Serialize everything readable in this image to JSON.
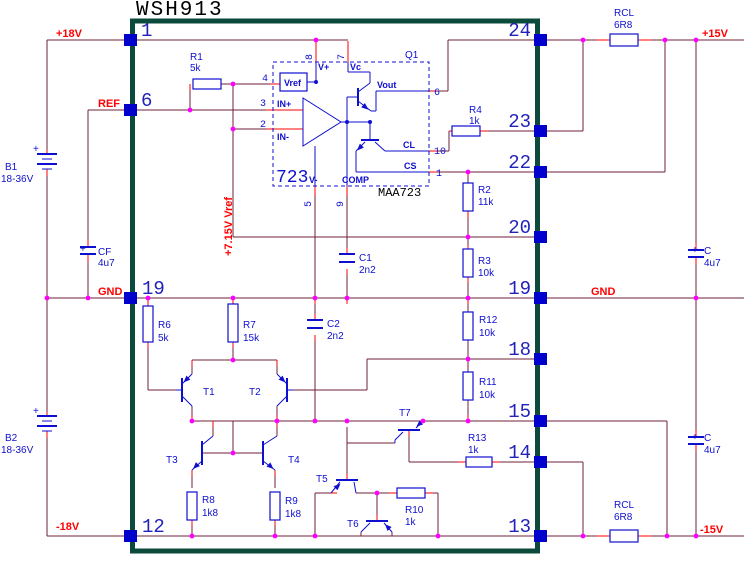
{
  "title": "WSH913",
  "part_label": "MAA723",
  "ic": {
    "big": "723",
    "q1": "Q1",
    "vref_box": "Vref",
    "ports": {
      "vplus": "V+",
      "vc": "Vc",
      "vminus": "V-",
      "comp": "COMP",
      "inp": "IN+",
      "inm": "IN-",
      "vout": "Vout",
      "cl": "CL",
      "cs": "CS"
    },
    "pin_numbers": {
      "n4": "4",
      "n3": "3",
      "n2": "2",
      "n8": "8",
      "n7": "7",
      "n6": "6",
      "n10": "10",
      "n1": "1",
      "n5": "5",
      "n9": "9"
    }
  },
  "nets": {
    "p18": "+18V",
    "ref": "REF",
    "gnd_left": "GND",
    "m18": "-18V",
    "p15": "+15V",
    "gnd_right": "GND",
    "m15": "-15V",
    "vref_rail": "+7.15V Vref"
  },
  "pins": {
    "left": [
      "1",
      "6",
      "19",
      "12"
    ],
    "right": [
      "24",
      "23",
      "22",
      "20",
      "19",
      "18",
      "15",
      "14",
      "13"
    ]
  },
  "batteries": {
    "b1": {
      "name": "B1",
      "value": "18-36V"
    },
    "b2": {
      "name": "B2",
      "value": "18-36V"
    }
  },
  "capacitors": {
    "cf": {
      "name": "CF",
      "value": "4u7"
    },
    "c1": {
      "name": "C1",
      "value": "2n2"
    },
    "c2": {
      "name": "C2",
      "value": "2n2"
    },
    "c_top": {
      "name": "C",
      "value": "4u7"
    },
    "c_bot": {
      "name": "C",
      "value": "4u7"
    }
  },
  "resistors": {
    "r1": {
      "name": "R1",
      "value": "5k"
    },
    "r2": {
      "name": "R2",
      "value": "11k"
    },
    "r3": {
      "name": "R3",
      "value": "10k"
    },
    "r4": {
      "name": "R4",
      "value": "1k"
    },
    "r6": {
      "name": "R6",
      "value": "5k"
    },
    "r7": {
      "name": "R7",
      "value": "15k"
    },
    "r8": {
      "name": "R8",
      "value": "1k8"
    },
    "r9": {
      "name": "R9",
      "value": "1k8"
    },
    "r10": {
      "name": "R10",
      "value": "1k"
    },
    "r11": {
      "name": "R11",
      "value": "10k"
    },
    "r12": {
      "name": "R12",
      "value": "10k"
    },
    "r13": {
      "name": "R13",
      "value": "1k"
    },
    "rcl_top": {
      "name": "RCL",
      "value": "6R8"
    },
    "rcl_bot": {
      "name": "RCL",
      "value": "6R8"
    }
  },
  "transistors": {
    "t1": "T1",
    "t2": "T2",
    "t3": "T3",
    "t4": "T4",
    "t5": "T5",
    "t6": "T6",
    "t7": "T7"
  },
  "symbols": {
    "plus": "+"
  },
  "colors": {
    "wire": "#71203a",
    "lead": "#ff0000",
    "component": "#0f0fd0",
    "junction": "#ff00ff",
    "ic_border": "#0c4a3c",
    "net_label": "#ff0000",
    "pin_number": "#2222bb",
    "pin_square": "#0000cc",
    "title": "#000000"
  }
}
